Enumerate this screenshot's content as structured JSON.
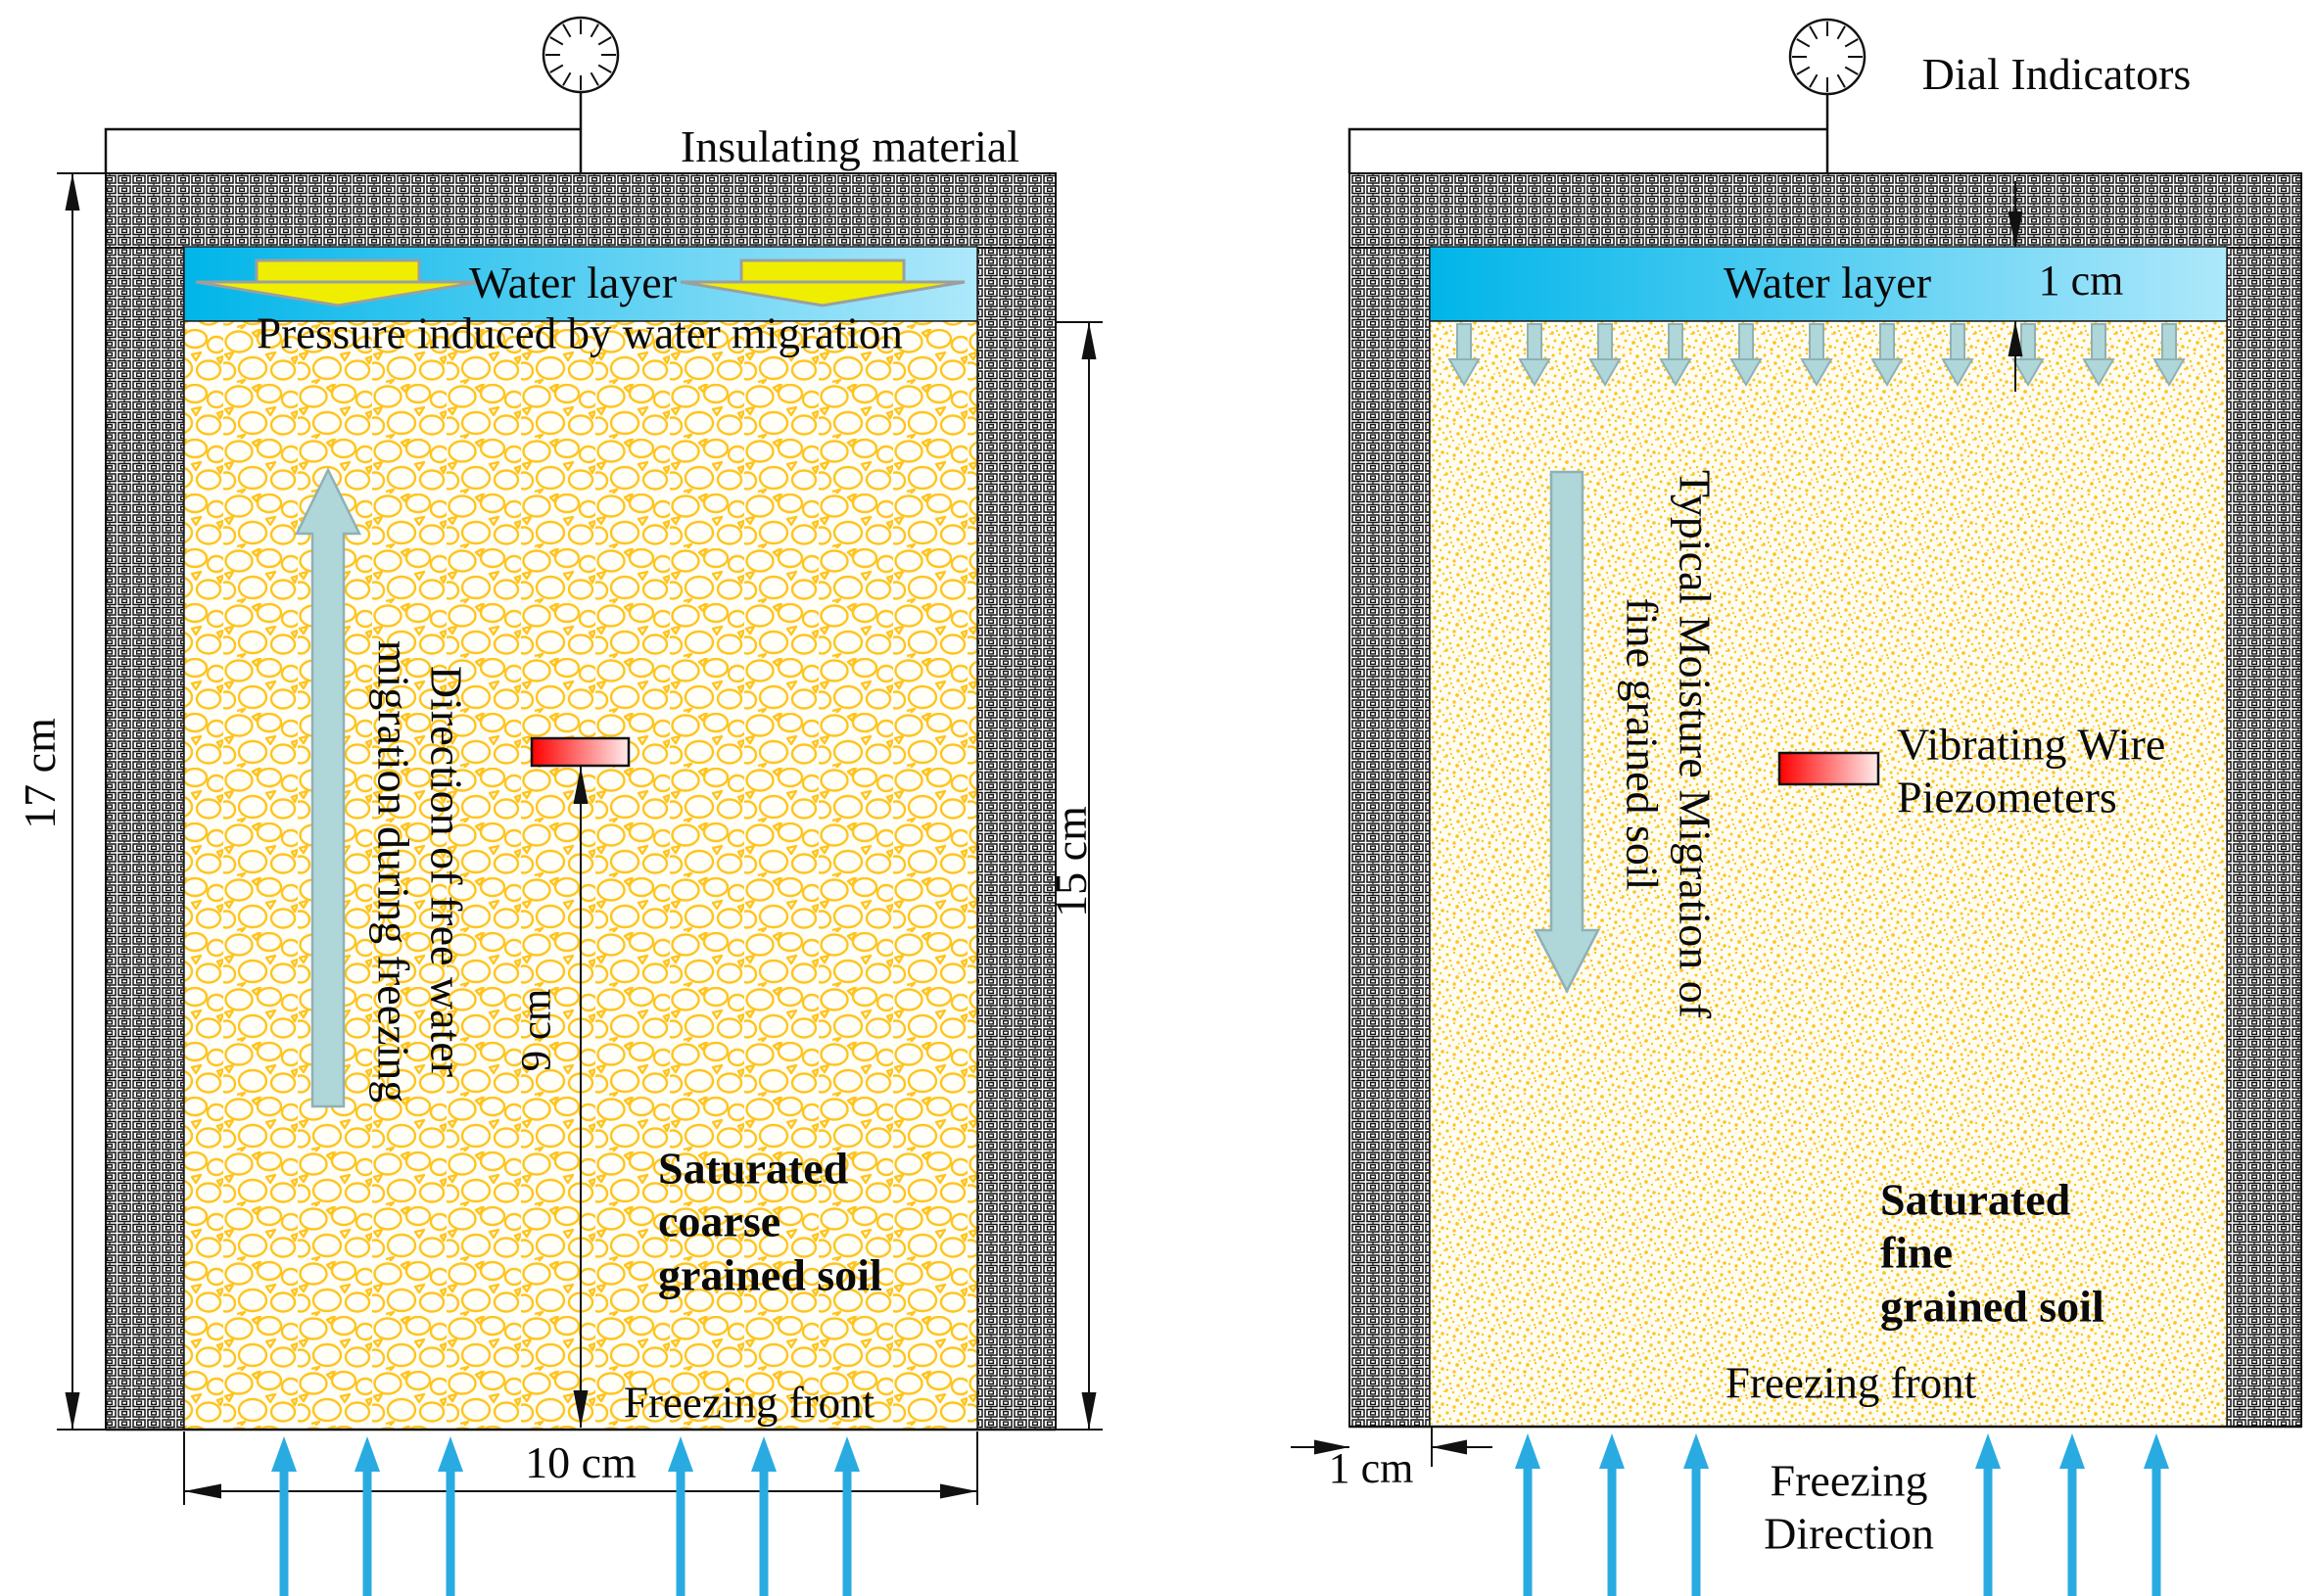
{
  "figure": {
    "type": "experimental-apparatus-schematic",
    "description": "Two freezing-test soil columns with insulated walls, water layer, piezometers and dial indicators"
  },
  "colors": {
    "water_gradient_start": "#00b5e9",
    "water_gradient_end": "#aee8fb",
    "soil_accent": "#ffc41e",
    "soil_background": "#fffdf4",
    "freeze_arrow": "#29abe2",
    "migration_arrow_fill": "#afd6d8",
    "migration_arrow_stroke": "#8fb0b5",
    "yellow_arrow": "#f0ee00",
    "piezometer_gradient_start": "#ff0000",
    "piezometer_gradient_end": "#ffecec",
    "line_color": "#111111"
  },
  "icons": {
    "dial_indicator": "dial-gauge-icon",
    "piezometer": "red-gradient-sensor-bar"
  },
  "left_panel": {
    "insulation_label": "Insulating material",
    "water_label": "Water layer",
    "pressure_label": "Pressure induced by water migration",
    "migration_direction_label": [
      "Direction of free water",
      "migration during freezing"
    ],
    "soil_label": [
      "Saturated",
      "coarse",
      "grained soil"
    ],
    "freezing_front_label": "Freezing front",
    "dims": {
      "height": "17 cm",
      "soil_height": "15 cm",
      "piezometer_depth": "9 cm",
      "width": "10 cm"
    }
  },
  "right_panel": {
    "dial_label": "Dial Indicators",
    "water_label": "Water layer",
    "water_depth_dim": "1 cm",
    "moisture_migration_label": [
      "Typical Moisture Migration of",
      "fine grained soil"
    ],
    "piezometer_label": [
      "Vibrating Wire",
      "Piezometers"
    ],
    "soil_label": [
      "Saturated",
      "fine",
      "grained soil"
    ],
    "freezing_front_label": "Freezing front",
    "wall_thickness_dim": "1 cm",
    "freezing_direction_label": [
      "Freezing",
      "Direction"
    ]
  }
}
